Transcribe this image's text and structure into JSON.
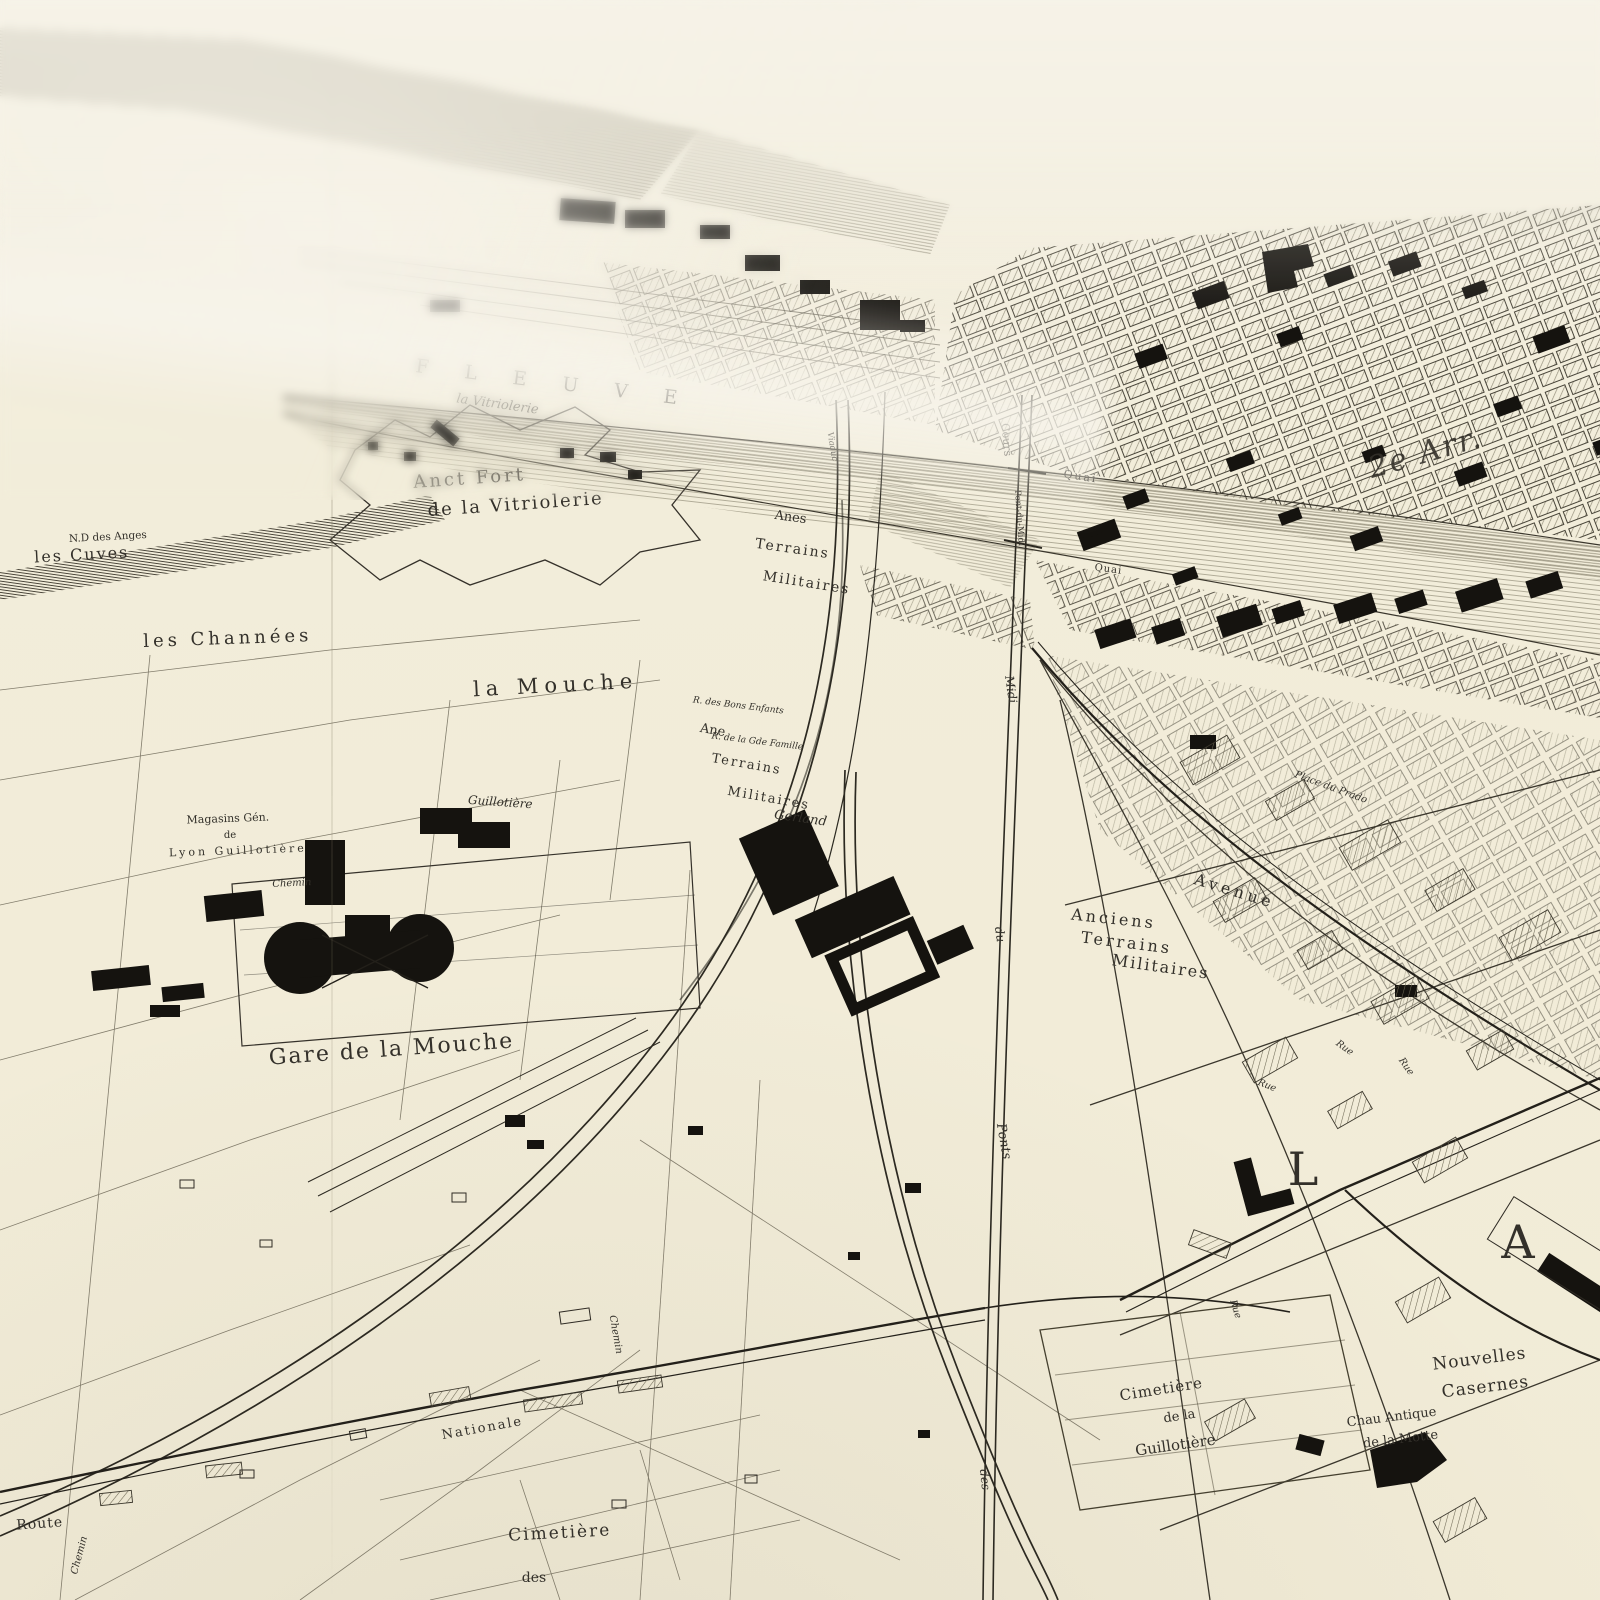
{
  "map": {
    "colors": {
      "paper": "#f2edda",
      "ink": "#33302a",
      "building_black": "#15130f",
      "hatch": "#6d6753",
      "river_flow": "#938d79"
    },
    "labels": {
      "fleuve": "F L E U V E",
      "vitriolerie_bank": "la Vitriolerie",
      "fort1": "Anct Fort",
      "fort2": "de la Vitriolerie",
      "nd_anges": "N.D des Anges",
      "cuves": "les Cuves",
      "channees": "les Channées",
      "mouche": "la Mouche",
      "anes": "Anes",
      "ane": "Ane",
      "terrains": "Terrains",
      "militaires": "Militaires",
      "anciens": "Anciens",
      "magasins1": "Magasins Gén.",
      "magasins2": "de",
      "magasins3": "Lyon Guillotière",
      "gare_mouche": "Gare de la Mouche",
      "avenue": "Avenue",
      "place_prado": "Place du Prado",
      "rue": "Rue",
      "gerland": "Gerland",
      "guillotiere_st": "Guillotière",
      "chemin": "Chemin",
      "bons_enfants": "R. des Bons Enfants",
      "gde_famille": "R. de la Gde Famille",
      "cours": "Cours",
      "pont_du_midi": "Pont-du-Midi",
      "midi": "Midi",
      "du": "du",
      "ponts": "Ponts",
      "des": "des",
      "quai": "Quai",
      "arr2": "2e Arr.",
      "letter_l": "L",
      "letter_a": "A",
      "nouvelles": "Nouvelles",
      "casernes": "Casernes",
      "chau1": "Chau Antique",
      "chau2": "de la Motte",
      "cimetiere": "Cimetière",
      "de_la": "de la",
      "guillotiere": "Guillotière",
      "route": "Route",
      "nationale": "Nationale",
      "viaduc": "Viaduc"
    }
  }
}
